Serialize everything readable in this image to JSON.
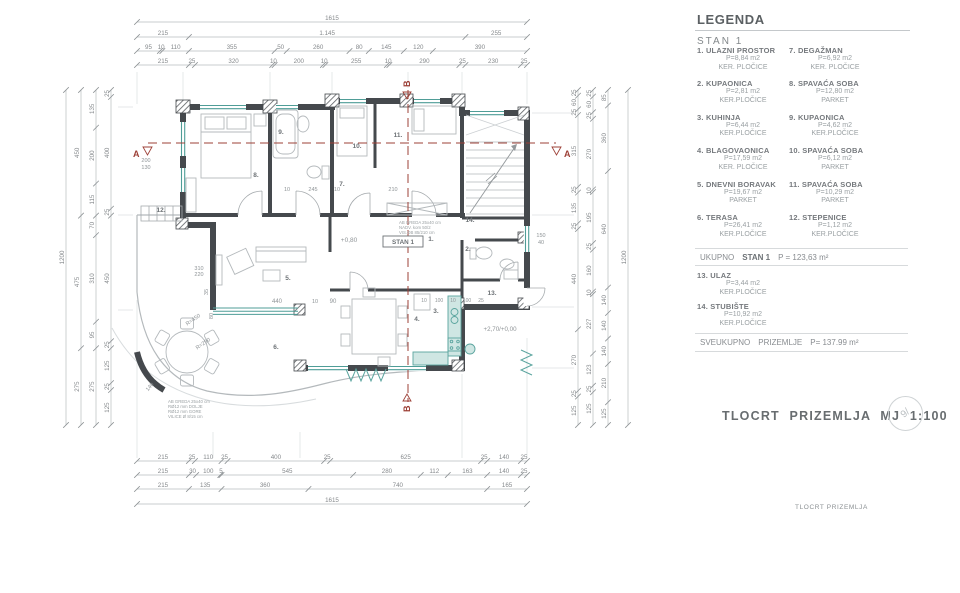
{
  "legend": {
    "title": "LEGENDA",
    "subtitle": "STAN 1",
    "entries_left": [
      {
        "num": "1.",
        "name": "ULAZNI PROSTOR",
        "area": "P=8,84 m2",
        "floor": "KER. PLOČICE"
      },
      {
        "num": "2.",
        "name": "KUPAONICA",
        "area": "P=2,81 m2",
        "floor": "KER.PLOČICE"
      },
      {
        "num": "3.",
        "name": "KUHINJA",
        "area": "P=6,44 m2",
        "floor": "KER.PLOČICE"
      },
      {
        "num": "4.",
        "name": "BLAGOVAONICA",
        "area": "P=17,59 m2",
        "floor": "KER. PLOČICE"
      },
      {
        "num": "5.",
        "name": "DNEVNI BORAVAK",
        "area": "P=19,67 m2",
        "floor": "PARKET"
      },
      {
        "num": "6.",
        "name": "TERASA",
        "area": "P=26,41 m2",
        "floor": "KER.PLOČICE"
      }
    ],
    "entries_right": [
      {
        "num": "7.",
        "name": "DEGAŽMAN",
        "area": "P=6,92 m2",
        "floor": "KER. PLOČICE"
      },
      {
        "num": "8.",
        "name": "SPAVAĆA SOBA",
        "area": "P=12,80 m2",
        "floor": "PARKET"
      },
      {
        "num": "9.",
        "name": "KUPAONICA",
        "area": "P=4,62 m2",
        "floor": "KER.PLOČICE"
      },
      {
        "num": "10.",
        "name": "SPAVAĆA SOBA",
        "area": "P=6,12 m2",
        "floor": "PARKET"
      },
      {
        "num": "11.",
        "name": "SPAVAĆA SOBA",
        "area": "P=10,29 m2",
        "floor": "PARKET"
      },
      {
        "num": "12.",
        "name": "STEPENICE",
        "area": "P=1,12 m2",
        "floor": "KER.PLOČICE"
      }
    ],
    "extra_entries": [
      {
        "num": "13.",
        "name": "ULAZ",
        "area": "P=3,44 m2",
        "floor": "KER.PLOČICE"
      },
      {
        "num": "14.",
        "name": "STUBIŠTE",
        "area": "P=10,92 m2",
        "floor": "KER.PLOČICE"
      }
    ],
    "total_line": {
      "l1": "UKUPNO",
      "l2": "STAN 1",
      "l3": "P = 123,63 m²"
    },
    "grand_line": {
      "l1": "SVEUKUPNO",
      "l2": "PRIZEMLJE",
      "l3": "P= 137.99 m²"
    }
  },
  "titles": {
    "main": "TLOCRT PRIZEMLJA MJ 1:100",
    "footer": "TLOCRT PRIZEMLJA",
    "stamp": "9/"
  },
  "plan": {
    "unit_label": "STAN 1",
    "section_a": "A",
    "section_b": "B",
    "room_labels": [
      "1.",
      "2.",
      "3.",
      "4.",
      "5.",
      "6.",
      "7.",
      "8.",
      "9.",
      "10.",
      "11.",
      "12.",
      "13.",
      "14."
    ],
    "inner_dims": [
      "+0,80",
      "+2,70/+0,00",
      "440",
      "90",
      "10",
      "R=450",
      "R=290",
      "310",
      "220",
      "35",
      "80",
      "10",
      "245",
      "10",
      "210",
      "150",
      "40",
      "200",
      "130",
      "10",
      "100",
      "10",
      "100",
      "25",
      "140"
    ],
    "notes_mid": [
      "AB GREDA 25x40 cm",
      "NADV. kom 50/2",
      "VIS.OB 85/210 cm"
    ],
    "notes_bottom": [
      "AB GREDA 25x40 cm",
      "RØ12 mm DOLJE",
      "RØ12 mm GORE",
      "VILICE Ø 8/15 cm"
    ]
  },
  "dimensions": {
    "top": [
      [
        "1615"
      ],
      [
        "215",
        "1.145",
        "255"
      ],
      [
        "95",
        "10",
        "110",
        "355",
        "50",
        "260",
        "80",
        "145",
        "120",
        "390"
      ],
      [
        "215",
        "25",
        "320",
        "10",
        "200",
        "10",
        "255",
        "10",
        "290",
        "25",
        "230",
        "25"
      ]
    ],
    "bottom": [
      [
        "215",
        "25",
        "110",
        "25",
        "400",
        "25",
        "625",
        "25",
        "140",
        "25"
      ],
      [
        "215",
        "30",
        "100",
        "5",
        "545",
        "280",
        "112",
        "163",
        "140",
        "25"
      ],
      [
        "215",
        "135",
        "360",
        "740",
        "165"
      ],
      [
        "1615"
      ]
    ],
    "left": [
      [
        "1200"
      ],
      [
        "450",
        "475",
        "275"
      ],
      [
        "135",
        "200",
        "115",
        "70",
        "310",
        "95",
        "275"
      ],
      [
        "25",
        "400",
        "25",
        "450",
        "25",
        "125",
        "25",
        "125"
      ]
    ],
    "right": [
      [
        "25",
        "60",
        "25",
        "315",
        "25",
        "135",
        "25",
        "440",
        "270",
        "25",
        "125"
      ],
      [
        "25",
        "60",
        "25",
        "270",
        "10",
        "195",
        "25",
        "160",
        "10",
        "227",
        "123",
        "25",
        "125"
      ],
      [
        "85",
        "360",
        "640",
        "140",
        "140",
        "140",
        "210",
        "125"
      ],
      [
        "1200"
      ]
    ]
  },
  "colors": {
    "wall": "#45494d",
    "window_teal": "#4f9d97",
    "section_red": "#9d4037",
    "dim_text": "#85898c"
  }
}
